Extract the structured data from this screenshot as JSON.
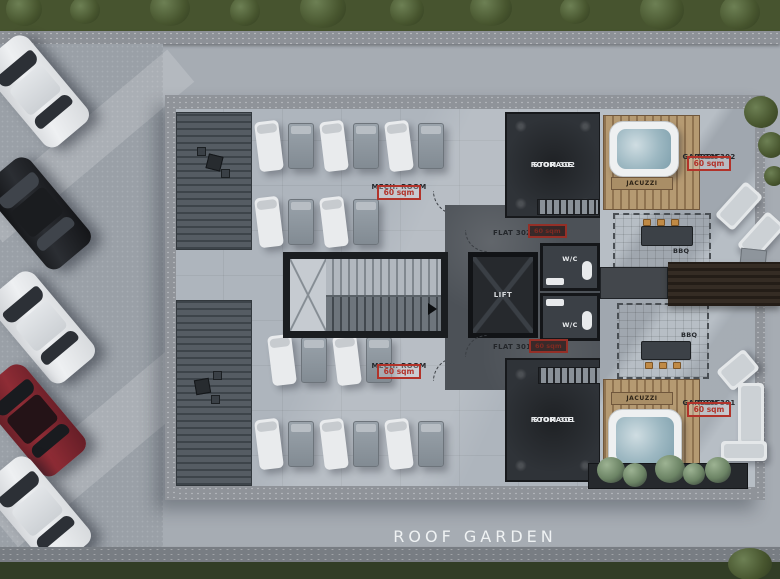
{
  "title": "ROOF GARDEN",
  "colors": {
    "annotation_red": "#b2332a",
    "roof_concrete": "#aeb5bd",
    "dark_room": "#2f3338",
    "deck_wood": "#b59a72",
    "grass": "#47542f"
  },
  "rooms": {
    "mech_room_top": {
      "label": "MECH. ROOM",
      "area": "60 sqm"
    },
    "mech_room_bottom": {
      "label": "MECH. ROOM",
      "area": "60 sqm"
    },
    "storage_302": {
      "line1": "STORAGE",
      "line2": "ROOM 302"
    },
    "storage_301": {
      "line1": "STORAGE",
      "line2": "ROOM 301"
    },
    "flat_302": {
      "label": "FLAT 302",
      "area": "60 sqm"
    },
    "flat_301": {
      "label": "FLAT 301",
      "area": "60 sqm"
    },
    "lift": {
      "label": "LIFT"
    },
    "wc_top": {
      "label": "W/C"
    },
    "wc_bottom": {
      "label": "W/C"
    },
    "jacuzzi_top": {
      "label": "JACUZZI"
    },
    "jacuzzi_bottom": {
      "label": "JACUZZI"
    },
    "roof_garden_302": {
      "line1": "ROOF",
      "line2": "GARDEN 302",
      "area": "60 sqm"
    },
    "roof_garden_301": {
      "line1": "ROOF",
      "line2": "GARDEN 301",
      "area": "60 sqm"
    },
    "bbq_top": {
      "label": "BBQ"
    },
    "bbq_bottom": {
      "label": "BBQ"
    }
  }
}
